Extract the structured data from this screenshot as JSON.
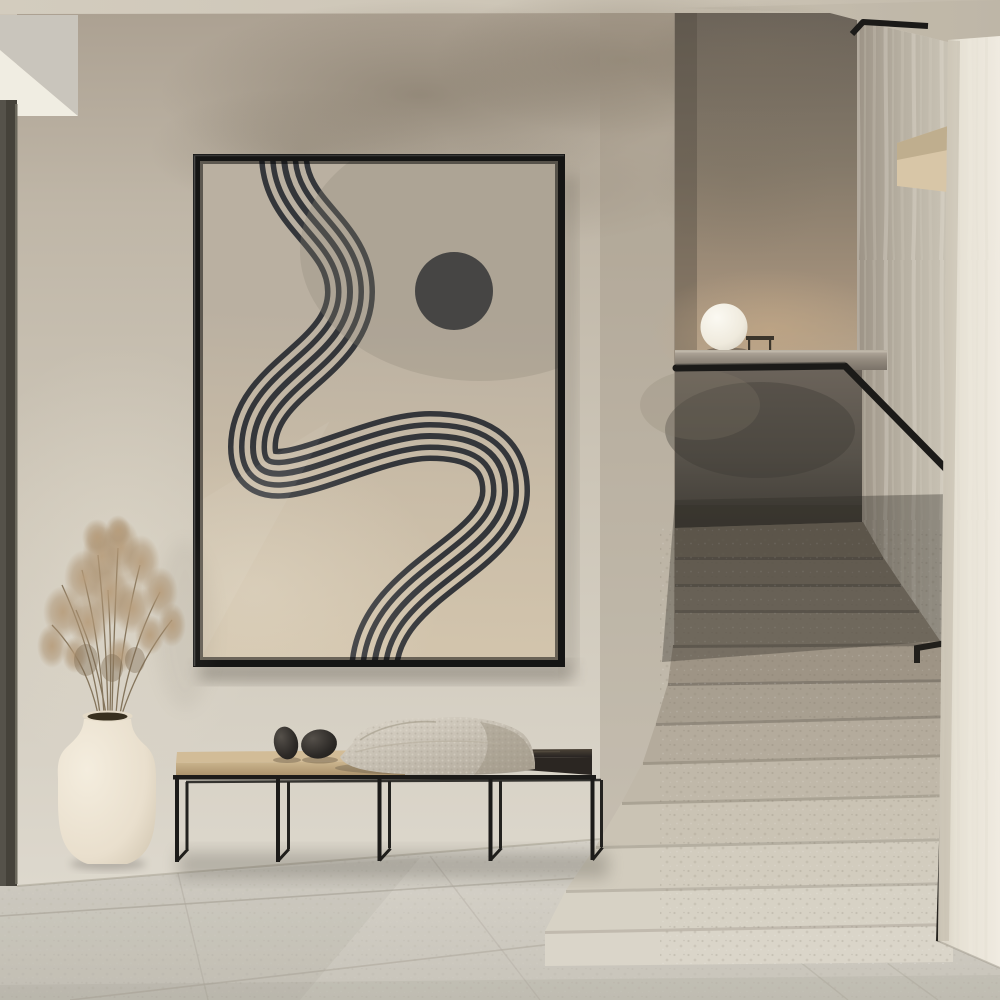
{
  "scene": {
    "type": "interior-photograph",
    "description": "Minimalist beige hallway: a large black-framed abstract print with five wavy lines and a black circle hangs over a low metal bench holding two black stones and a knit throw; a cream ceramic vase with dried grass stands at left; at right a terrazzo staircase with a flat black handrail climbs past a concrete ledge with a glowing white sphere lamp.",
    "style": "japandi modern minimal",
    "lighting": "soft diffused daylight from upper left"
  },
  "artwork": {
    "motif": "five parallel hand-drawn lines meandering from top edge to bottom edge, solid circle upper right",
    "line_count": 5,
    "frame_color": "#151514",
    "canvas_top_color": "#bab0a1",
    "canvas_bottom_color": "#d9cbb2",
    "line_color": "#34363a",
    "circle_color": "#2b2d31"
  },
  "objects": {
    "vase": {
      "color": "#ece3d2",
      "contents": "dried pampas grass",
      "plant_color": "#ab9172"
    },
    "bench": {
      "frame_color": "#1c1b19",
      "cushion_color": "#c6ae88",
      "wood_top_color": "#2e2925",
      "bays": 4
    },
    "throw_blanket": {
      "color": "#cdc6b9",
      "texture": "knit"
    },
    "decor_stones": {
      "count": 2,
      "color": "#262422"
    },
    "sphere_lamp": {
      "color": "#f4f1e9",
      "position": "on concrete ledge"
    },
    "handrail": {
      "color": "#1d1c1a",
      "material": "flat black steel"
    }
  },
  "architecture": {
    "ceiling_color": "#cdc5b7",
    "front_wall_color": "#c9c2b4",
    "stairwell_back_wall_color": "#857a6c",
    "stairwell_side_wall_color": "#bcb5a8",
    "guard_wall_color": "#554f47",
    "right_wall_color": "#e9e4d8",
    "left_panel_color": "#46433a",
    "visible_step_count": 12,
    "step_material": "terrazzo",
    "upper_steps_color": "#7e7568",
    "lower_steps_color": "#d7d2c5",
    "floor_color": "#d2cec4",
    "floor_material": "large stone tiles"
  }
}
